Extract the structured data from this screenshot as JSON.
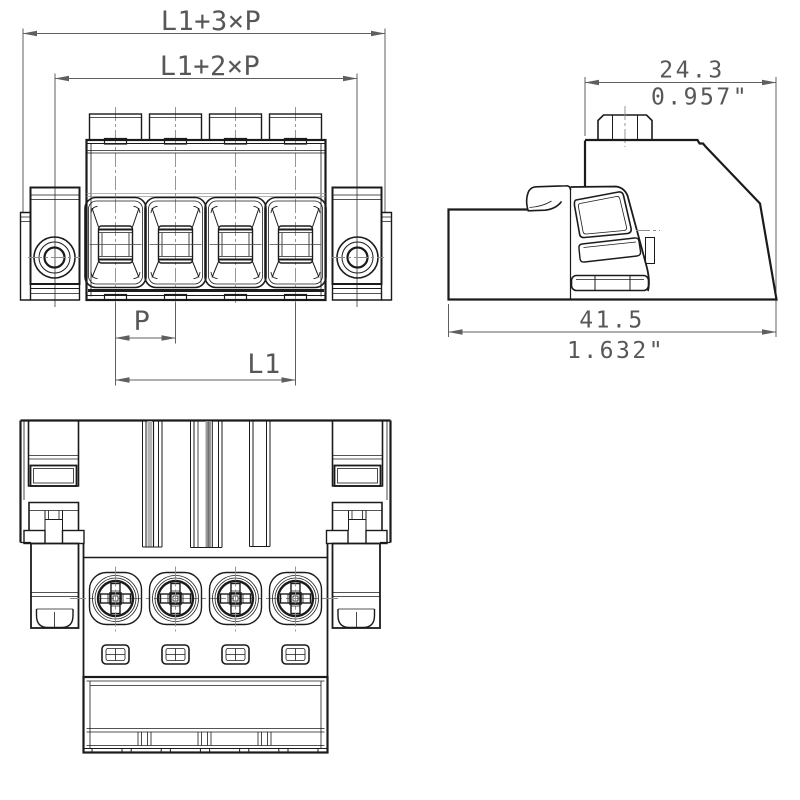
{
  "front_view": {
    "dim_overall": "L1+3×P",
    "dim_mounting": "L1+2×P",
    "dim_pitch": "P",
    "dim_span": "L1",
    "pole_count": 4
  },
  "side_view": {
    "upper_depth_mm": "24.3",
    "upper_depth_in": "0.957\"",
    "overall_depth_mm": "41.5",
    "overall_depth_in": "1.632\""
  },
  "colors": {
    "line": "#1b1b1b",
    "dimension": "#5f5f5f",
    "centerline": "#8c8c8c",
    "background": "#ffffff"
  }
}
